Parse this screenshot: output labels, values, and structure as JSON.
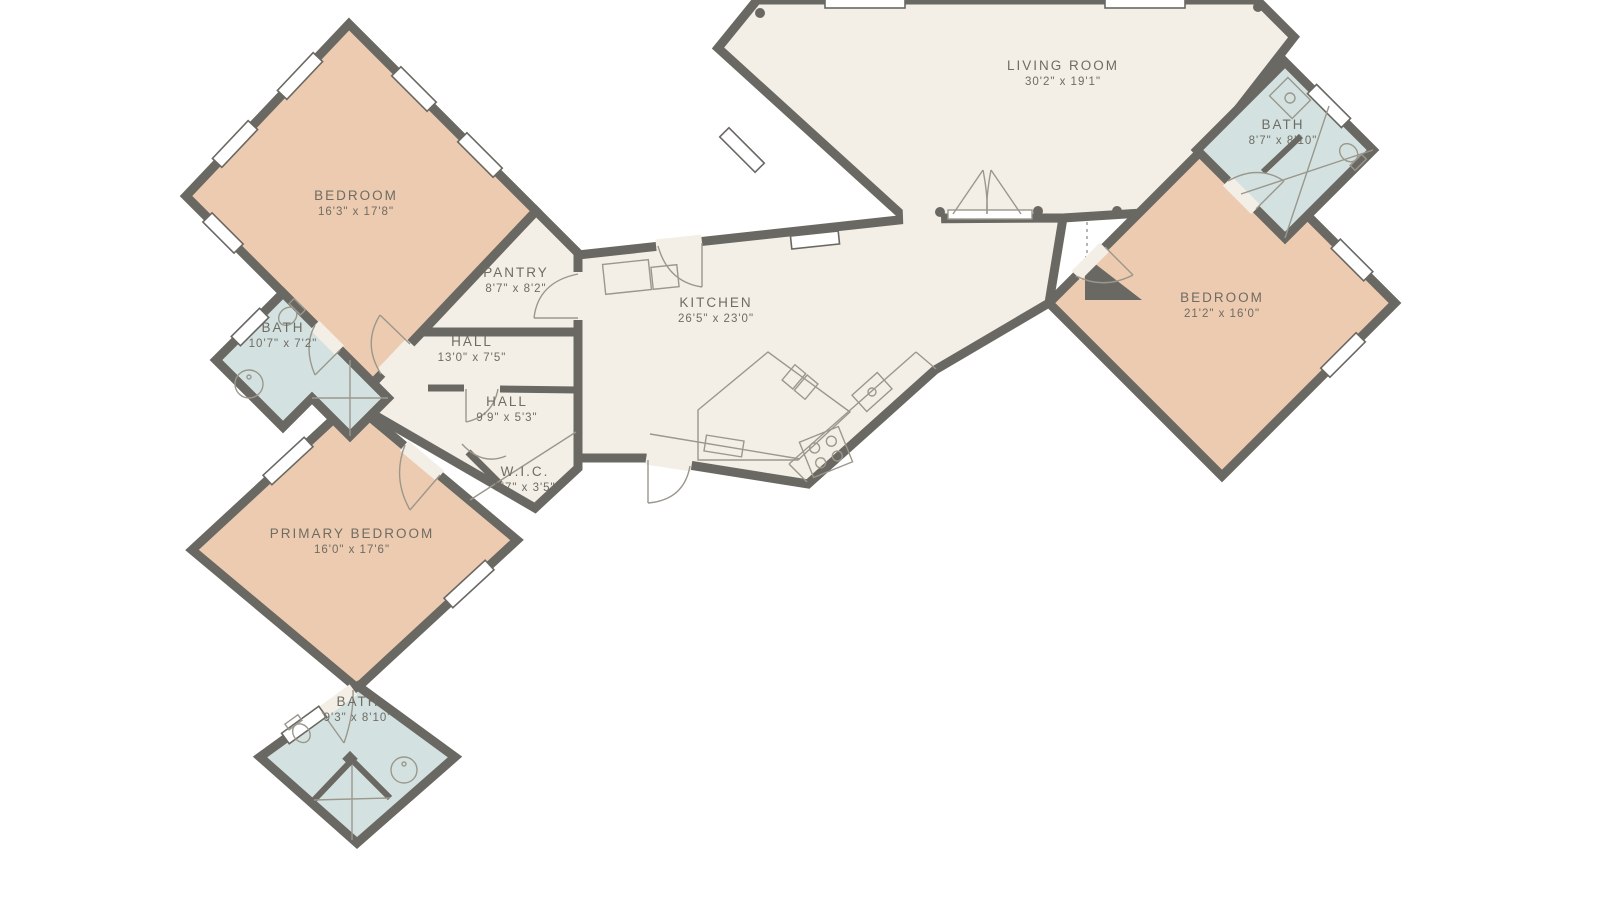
{
  "plan": {
    "title": "floor-plan",
    "colors": {
      "wall": "#6a6862",
      "floor": "#f3efe7",
      "bedroom_fill": "#edcbb0",
      "bath_fill": "#d3e2e1",
      "fixture_line": "#9b978c",
      "label_text": "#6f6c63",
      "background": "#ffffff"
    },
    "rooms": [
      {
        "id": "living-room",
        "name": "LIVING ROOM",
        "dims": "30'2\" x 19'1\""
      },
      {
        "id": "bath-right",
        "name": "BATH",
        "dims": "8'7\" x 8'10\""
      },
      {
        "id": "bedroom-right",
        "name": "BEDROOM",
        "dims": "21'2\" x 16'0\""
      },
      {
        "id": "bedroom-top-left",
        "name": "BEDROOM",
        "dims": "16'3\" x 17'8\""
      },
      {
        "id": "pantry",
        "name": "PANTRY",
        "dims": "8'7\" x 8'2\""
      },
      {
        "id": "hall-main",
        "name": "HALL",
        "dims": "13'0\" x 7'5\""
      },
      {
        "id": "hall-small",
        "name": "HALL",
        "dims": "9'9\" x 5'3\""
      },
      {
        "id": "kitchen",
        "name": "KITCHEN",
        "dims": "26'5\" x 23'0\""
      },
      {
        "id": "wic",
        "name": "W.I.C.",
        "dims": "5'7\" x 3'5\""
      },
      {
        "id": "bath-left",
        "name": "BATH",
        "dims": "10'7\" x 7'2\""
      },
      {
        "id": "primary-bedroom",
        "name": "PRIMARY BEDROOM",
        "dims": "16'0\" x 17'6\""
      },
      {
        "id": "bath-bottom",
        "name": "BATH",
        "dims": "9'3\" x 8'10\""
      }
    ]
  }
}
